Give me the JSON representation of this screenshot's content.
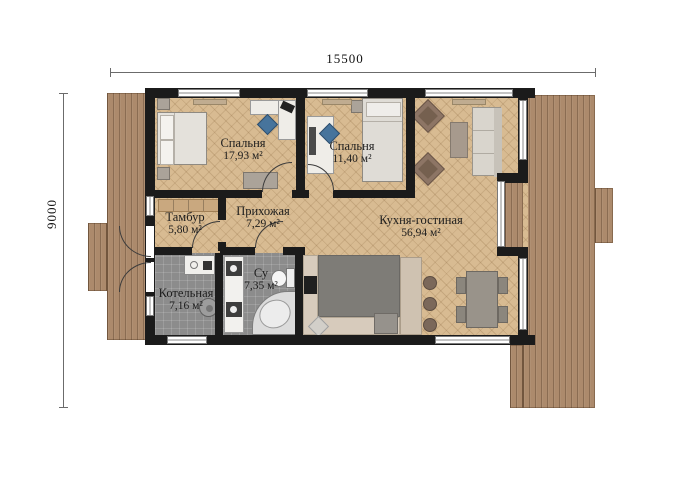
{
  "title": "Floor plan",
  "dimensions": {
    "width_label": "15500",
    "height_label": "9000"
  },
  "rooms": [
    {
      "id": "bedroom-1",
      "name": "Спальня",
      "area": "17,93 м²"
    },
    {
      "id": "bedroom-2",
      "name": "Спальня",
      "area": "11,40 м²"
    },
    {
      "id": "kitchen-living",
      "name": "Кухня-гостиная",
      "area": "56,94 м²"
    },
    {
      "id": "tambour",
      "name": "Тамбур",
      "area": "5,80 м²"
    },
    {
      "id": "hallway",
      "name": "Прихожая",
      "area": "7,29 м²"
    },
    {
      "id": "boiler-room",
      "name": "Котельная",
      "area": "7,16 м²"
    },
    {
      "id": "bathroom",
      "name": "Су",
      "area": "7,35 м²"
    }
  ],
  "colors": {
    "wall": "#1b1b1b",
    "parquet_floor": "#d8bb92",
    "deck_wood": "#ac8a6c",
    "tile_floor": "#8c8c8c",
    "chair_accent": "#47749c",
    "background": "#ffffff"
  }
}
